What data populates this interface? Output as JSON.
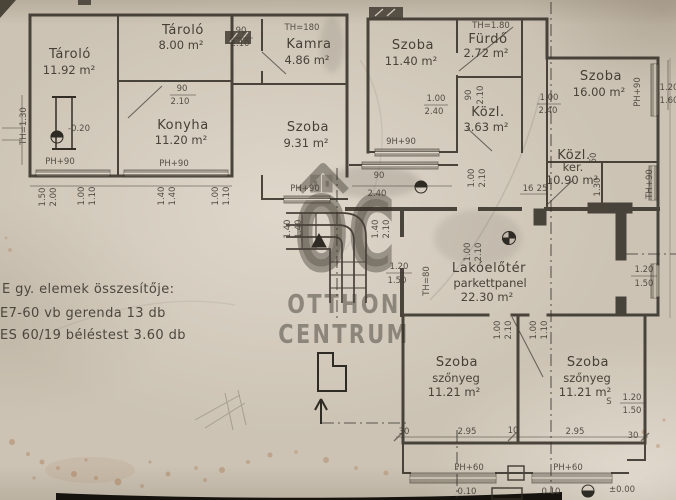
{
  "document": {
    "type": "scanned hand-drawn floor plan",
    "language": "Hungarian"
  },
  "watermark": {
    "logo_text": "ÖC",
    "name_line1": "OTTHON",
    "name_line2": "CENTRUM"
  },
  "rooms": [
    {
      "name": "Tároló",
      "area": "11.92 m²"
    },
    {
      "name": "Tároló",
      "area": "8.00 m²"
    },
    {
      "name": "Kamra",
      "area": "4.86 m²"
    },
    {
      "name": "Szoba",
      "area": "11.40 m²"
    },
    {
      "name": "Fürdő",
      "area": "2.72 m²"
    },
    {
      "name": "Szoba",
      "area": "16.00 m²"
    },
    {
      "name": "Konyha",
      "area": "11.20 m²"
    },
    {
      "name": "Szoba",
      "area": "9.31 m²"
    },
    {
      "name": "Közl.",
      "area": "3.63 m²"
    },
    {
      "name": "Közl.",
      "name2": "ker.",
      "area": "10.90 m²"
    },
    {
      "name": "Lakóelőtér",
      "floor": "parkettpanel",
      "area": "22.30 m²"
    },
    {
      "name": "Szoba",
      "floor": "szőnyeg",
      "area": "11.21 m²"
    },
    {
      "name": "Szoba",
      "floor": "szőnyeg",
      "area": "11.21 m²"
    }
  ],
  "notes": {
    "title": "E gy. elemek összesítője:",
    "line1": "E7-60      vb gerenda        13 db",
    "line2": "ES 60/19  béléstest          3.60 db"
  },
  "dims": [
    "90",
    "2.10",
    "TH=180",
    "TH=1.80",
    "1.00",
    "2.40",
    "90",
    "2.10",
    "1.00",
    "2.40",
    "PH+90",
    "TH+90",
    "50",
    "1.30",
    "16",
    "25",
    "90",
    "2.10",
    "TH=1.30",
    "-0.20",
    "PH+90",
    "PH+90",
    "PH+90",
    "9H+90",
    "1.50",
    "2.00",
    "1.00",
    "1.10",
    "1.40",
    "1.40",
    "1.00",
    "1.10",
    "1.40",
    "1.40",
    "1.40",
    "2.10",
    "90",
    "2.40",
    "1.00",
    "2.10",
    "1.00",
    "2.10",
    "1.20",
    "1.50",
    "TH=80",
    "1.00",
    "2.10",
    "1.00",
    "1.10",
    "1.20",
    "1.50",
    "S",
    "1.20",
    "1.50",
    "30",
    "2.95",
    "10",
    "2.95",
    "30",
    "PH+60",
    "PH+60",
    "0.10",
    "0.10",
    "±0.00",
    "1.20",
    "1.60"
  ],
  "colors": {
    "paper": "#ccc3b4",
    "ink": "#322d25",
    "pencil": "#4a443c",
    "watermark": "#6f6960",
    "stain": "#9a5a2a"
  }
}
